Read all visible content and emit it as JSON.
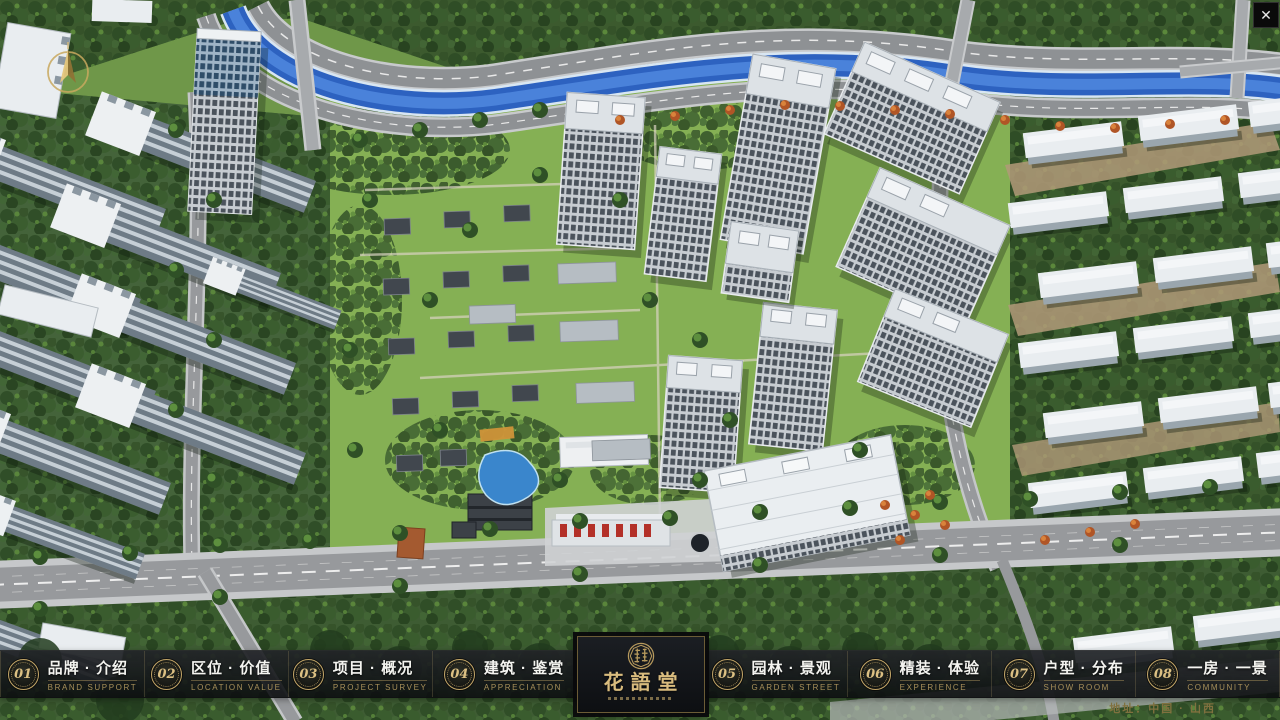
{
  "window": {
    "close_label": "✕"
  },
  "theme": {
    "gold": "#c2a567",
    "gold_dim": "#80713f",
    "bar_bg": "rgba(16,18,21,0.9)",
    "panel_bg": "#101318",
    "text_white": "#f4f4f0"
  },
  "nav": {
    "items": [
      {
        "num": "01",
        "label": "品牌 · 介绍",
        "sub": "BRAND SUPPORT"
      },
      {
        "num": "02",
        "label": "区位 · 价值",
        "sub": "LOCATION VALUE"
      },
      {
        "num": "03",
        "label": "项目 · 概况",
        "sub": "PROJECT SURVEY"
      },
      {
        "num": "04",
        "label": "建筑 · 鉴赏",
        "sub": "APPRECIATION"
      },
      {
        "num": "05",
        "label": "园林 · 景观",
        "sub": "GARDEN STREET"
      },
      {
        "num": "06",
        "label": "精装 · 体验",
        "sub": "EXPERIENCE"
      },
      {
        "num": "07",
        "label": "户型 · 分布",
        "sub": "SHOW ROOM"
      },
      {
        "num": "08",
        "label": "一房 · 一景",
        "sub": "COMMUNITY"
      }
    ]
  },
  "logo": {
    "title": "花語堂"
  },
  "footer": {
    "address": "地址：中国 · 山西"
  }
}
